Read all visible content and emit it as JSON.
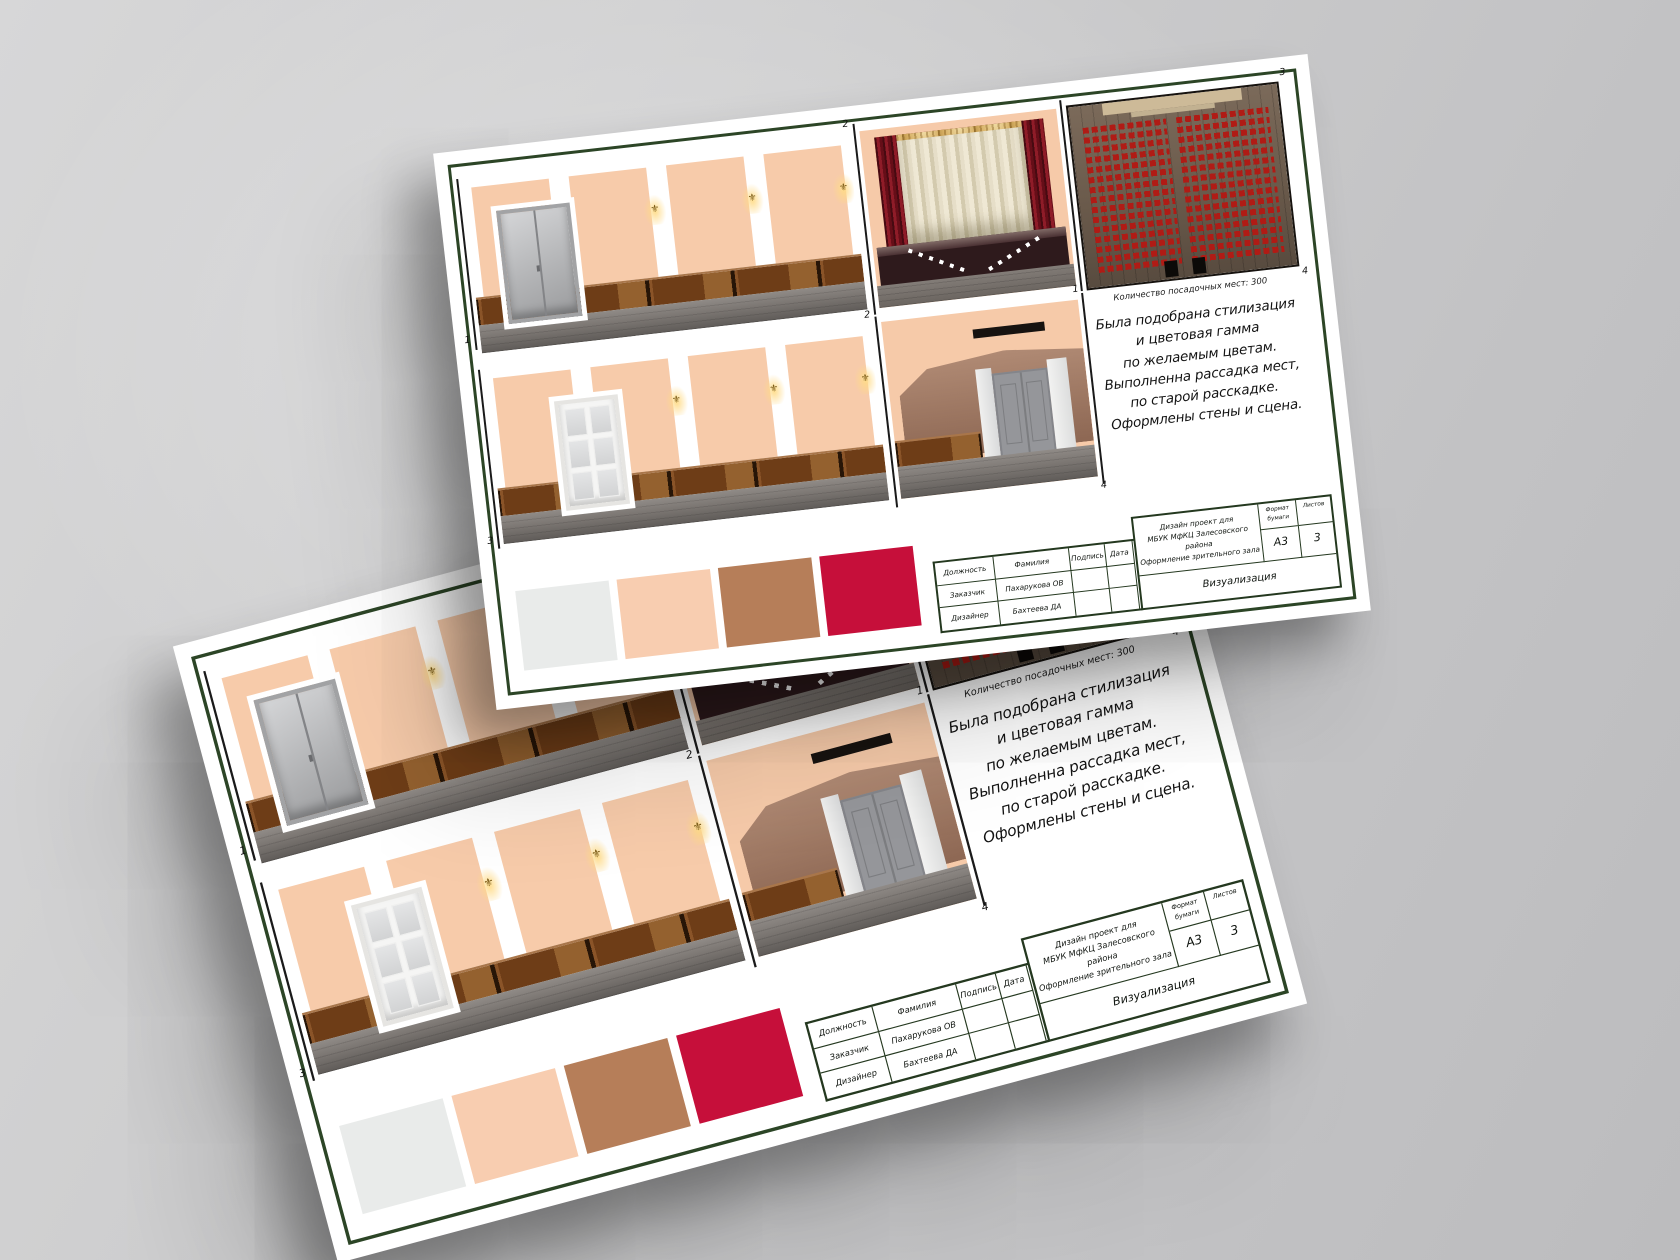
{
  "scene": {
    "background_color": "#c7c8c9",
    "sheet_count": "2"
  },
  "sheet": {
    "frame_color": "#2c4526",
    "view_labels": {
      "elevation1": "1",
      "stage": "2",
      "plan_top_right": "3",
      "plan_bottom_left": "1",
      "plan_bottom_right": "4",
      "elevation2": "3",
      "back_top_left": "2",
      "back_bottom_right": "4"
    },
    "plan_caption": "Количество посадочных мест: 300",
    "text_block": {
      "lines": [
        "Была подобрана стилизация",
        "и цветовая гамма",
        "по желаемым цветам.",
        "Выполненна рассадка мест,",
        "по старой расскадке.",
        "Оформлены стены и сцена."
      ]
    },
    "swatches": [
      {
        "name": "white-gray",
        "color": "#e9ebea"
      },
      {
        "name": "peach",
        "color": "#f8cdb0"
      },
      {
        "name": "tan-brown",
        "color": "#b67e59"
      },
      {
        "name": "crimson",
        "color": "#c60f3a"
      }
    ],
    "title_block": {
      "col_position": "Должность",
      "col_surname": "Фамилия",
      "col_signature": "Подпись",
      "col_date": "Дата",
      "row_customer_position": "Заказчик",
      "row_customer_surname": "Пахарукова ОВ",
      "row_designer_position": "Дизайнер",
      "row_designer_surname": "Бахтеева ДА",
      "project_line1": "Дизайн проект для",
      "project_line2": "МБУК МфКЦ Залесовского района",
      "project_line3": "Оформление зрительного зала",
      "format_label_line1": "Формат",
      "format_label_line2": "бумаги",
      "format_value": "A3",
      "sheets_label": "Листов",
      "sheets_value": "3",
      "stage_name": "Визуализация"
    }
  }
}
